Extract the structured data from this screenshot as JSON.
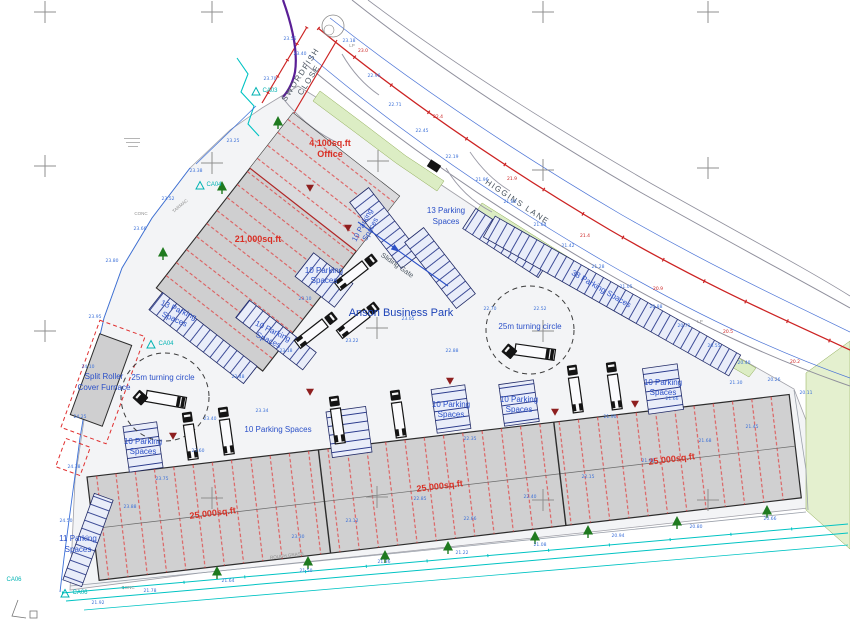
{
  "labels": {
    "park_name": "Anson Business Park",
    "higgins": "HIGGINS LANE",
    "swordfish1": "SWORDFISH",
    "swordfish2": "CLOSE",
    "office1": "4,100sq.ft",
    "office2": "Office",
    "unit21": "21,000sq.ft",
    "unit25": "25,000sq.ft",
    "p13a": "13 Parking",
    "p13b": "Spaces",
    "p10a": "10 Parking",
    "p10b": "Spaces",
    "p10": "10 Parking Spaces",
    "p11a": "11 Parking",
    "p11b": "Spaces",
    "p38": "38 Parking Spaces",
    "turning": "25m turning circle",
    "gate": "Sliding Gate",
    "split1": "Split Roller",
    "split2": "Cover Furnace",
    "ca03": "CA03",
    "ca04": "CA04",
    "ca06": "CA06",
    "lp": "LP",
    "conc": "CONC",
    "tarmac": "TARMAC",
    "rough": "ROUGH GRASS"
  },
  "dim_marks": [
    {
      "x": 349,
      "y": 42,
      "t": "23.18",
      "c": "b"
    },
    {
      "x": 374,
      "y": 77,
      "t": "22.96",
      "c": "b"
    },
    {
      "x": 300,
      "y": 55,
      "t": "23.40",
      "c": "b"
    },
    {
      "x": 395,
      "y": 106,
      "t": "22.71",
      "c": "b"
    },
    {
      "x": 422,
      "y": 132,
      "t": "22.45",
      "c": "b"
    },
    {
      "x": 452,
      "y": 158,
      "t": "22.19",
      "c": "b"
    },
    {
      "x": 482,
      "y": 181,
      "t": "21.96",
      "c": "b"
    },
    {
      "x": 510,
      "y": 203,
      "t": "21.80",
      "c": "b"
    },
    {
      "x": 540,
      "y": 226,
      "t": "21.64",
      "c": "b"
    },
    {
      "x": 568,
      "y": 247,
      "t": "21.42",
      "c": "b"
    },
    {
      "x": 598,
      "y": 268,
      "t": "21.28",
      "c": "b"
    },
    {
      "x": 626,
      "y": 288,
      "t": "21.05",
      "c": "b"
    },
    {
      "x": 656,
      "y": 308,
      "t": "20.88",
      "c": "b"
    },
    {
      "x": 684,
      "y": 327,
      "t": "20.71",
      "c": "b"
    },
    {
      "x": 714,
      "y": 347,
      "t": "20.55",
      "c": "b"
    },
    {
      "x": 744,
      "y": 364,
      "t": "20.40",
      "c": "b"
    },
    {
      "x": 774,
      "y": 381,
      "t": "20.26",
      "c": "b"
    },
    {
      "x": 806,
      "y": 394,
      "t": "20.11",
      "c": "b"
    },
    {
      "x": 290,
      "y": 40,
      "t": "23.55",
      "c": "b"
    },
    {
      "x": 270,
      "y": 80,
      "t": "23.70",
      "c": "b"
    },
    {
      "x": 363,
      "y": 52,
      "t": "23.0",
      "c": "r"
    },
    {
      "x": 438,
      "y": 118,
      "t": "22.4",
      "c": "r"
    },
    {
      "x": 512,
      "y": 180,
      "t": "21.9",
      "c": "r"
    },
    {
      "x": 585,
      "y": 237,
      "t": "21.4",
      "c": "r"
    },
    {
      "x": 658,
      "y": 290,
      "t": "20.9",
      "c": "r"
    },
    {
      "x": 728,
      "y": 333,
      "t": "20.5",
      "c": "r"
    },
    {
      "x": 795,
      "y": 363,
      "t": "20.2",
      "c": "r"
    },
    {
      "x": 238,
      "y": 378,
      "t": "23.48",
      "c": "b"
    },
    {
      "x": 305,
      "y": 300,
      "t": "23.10",
      "c": "b"
    },
    {
      "x": 352,
      "y": 342,
      "t": "23.22",
      "c": "b"
    },
    {
      "x": 408,
      "y": 320,
      "t": "23.05",
      "c": "b"
    },
    {
      "x": 452,
      "y": 352,
      "t": "22.88",
      "c": "b"
    },
    {
      "x": 490,
      "y": 310,
      "t": "22.70",
      "c": "b"
    },
    {
      "x": 540,
      "y": 310,
      "t": "22.52",
      "c": "b"
    },
    {
      "x": 610,
      "y": 418,
      "t": "21.90",
      "c": "b"
    },
    {
      "x": 470,
      "y": 440,
      "t": "22.35",
      "c": "b"
    },
    {
      "x": 672,
      "y": 400,
      "t": "21.66",
      "c": "b"
    },
    {
      "x": 736,
      "y": 384,
      "t": "21.30",
      "c": "b"
    },
    {
      "x": 198,
      "y": 452,
      "t": "23.60",
      "c": "b"
    },
    {
      "x": 162,
      "y": 480,
      "t": "23.75",
      "c": "b"
    },
    {
      "x": 130,
      "y": 508,
      "t": "23.88",
      "c": "b"
    },
    {
      "x": 298,
      "y": 538,
      "t": "23.30",
      "c": "b"
    },
    {
      "x": 352,
      "y": 522,
      "t": "23.12",
      "c": "b"
    },
    {
      "x": 420,
      "y": 500,
      "t": "22.85",
      "c": "b"
    },
    {
      "x": 470,
      "y": 520,
      "t": "22.66",
      "c": "b"
    },
    {
      "x": 530,
      "y": 498,
      "t": "22.40",
      "c": "b"
    },
    {
      "x": 588,
      "y": 478,
      "t": "22.15",
      "c": "b"
    },
    {
      "x": 648,
      "y": 462,
      "t": "21.92",
      "c": "b"
    },
    {
      "x": 705,
      "y": 442,
      "t": "21.68",
      "c": "b"
    },
    {
      "x": 752,
      "y": 428,
      "t": "21.45",
      "c": "b"
    },
    {
      "x": 95,
      "y": 318,
      "t": "23.95",
      "c": "b"
    },
    {
      "x": 88,
      "y": 368,
      "t": "24.10",
      "c": "b"
    },
    {
      "x": 80,
      "y": 418,
      "t": "24.25",
      "c": "b"
    },
    {
      "x": 74,
      "y": 468,
      "t": "24.38",
      "c": "b"
    },
    {
      "x": 66,
      "y": 522,
      "t": "24.50",
      "c": "b"
    },
    {
      "x": 112,
      "y": 262,
      "t": "23.80",
      "c": "b"
    },
    {
      "x": 140,
      "y": 230,
      "t": "23.66",
      "c": "b"
    },
    {
      "x": 168,
      "y": 200,
      "t": "23.52",
      "c": "b"
    },
    {
      "x": 196,
      "y": 172,
      "t": "23.38",
      "c": "b"
    },
    {
      "x": 233,
      "y": 142,
      "t": "23.25",
      "c": "b"
    },
    {
      "x": 150,
      "y": 592,
      "t": "21.78",
      "c": "b"
    },
    {
      "x": 228,
      "y": 582,
      "t": "21.64",
      "c": "b"
    },
    {
      "x": 306,
      "y": 572,
      "t": "21.50",
      "c": "b"
    },
    {
      "x": 384,
      "y": 563,
      "t": "21.36",
      "c": "b"
    },
    {
      "x": 462,
      "y": 554,
      "t": "21.22",
      "c": "b"
    },
    {
      "x": 540,
      "y": 546,
      "t": "21.08",
      "c": "b"
    },
    {
      "x": 618,
      "y": 537,
      "t": "20.94",
      "c": "b"
    },
    {
      "x": 696,
      "y": 528,
      "t": "20.80",
      "c": "b"
    },
    {
      "x": 770,
      "y": 520,
      "t": "20.66",
      "c": "b"
    },
    {
      "x": 98,
      "y": 604,
      "t": "21.92",
      "c": "b"
    },
    {
      "x": 210,
      "y": 420,
      "t": "23.40",
      "c": "b"
    },
    {
      "x": 286,
      "y": 352,
      "t": "23.18",
      "c": "b"
    },
    {
      "x": 262,
      "y": 412,
      "t": "23.34",
      "c": "b"
    }
  ]
}
